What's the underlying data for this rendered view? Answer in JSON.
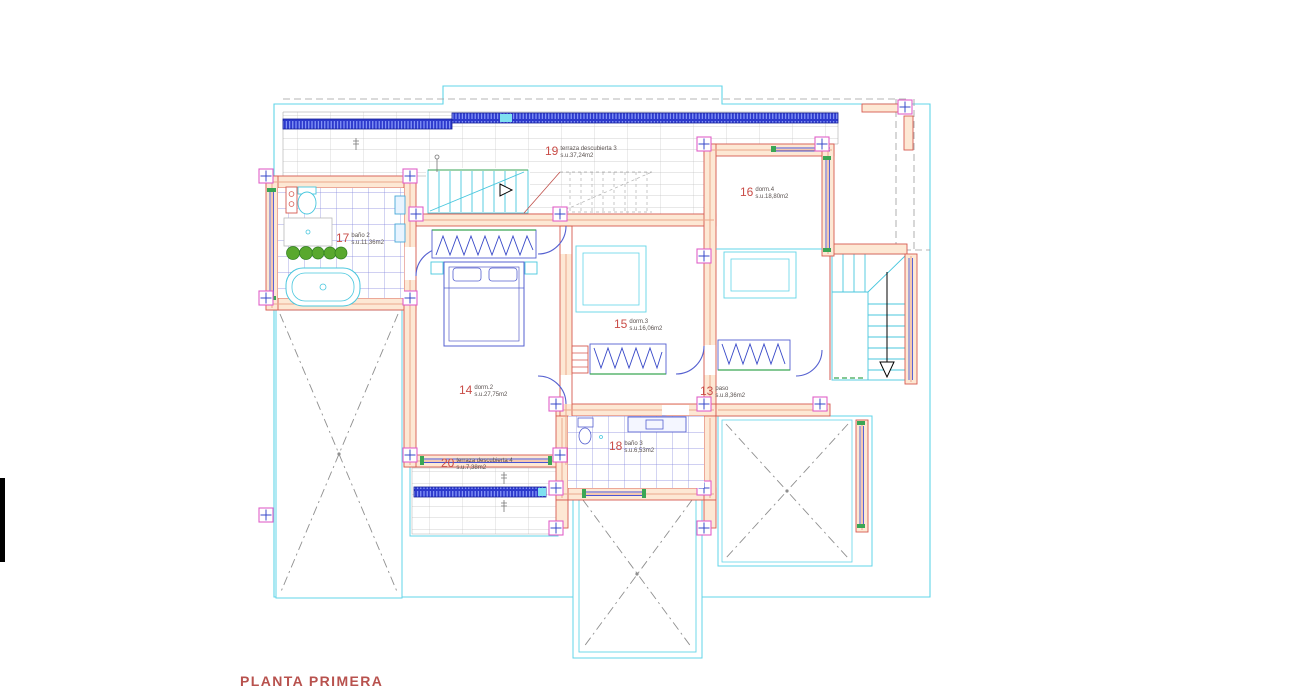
{
  "drawing": {
    "title": "PLANTA PRIMERA",
    "rooms": [
      {
        "id": "19",
        "name": "terraza descubierta 3",
        "area": "s.u.37,24m2"
      },
      {
        "id": "16",
        "name": "dorm.4",
        "area": "s.u.18,80m2"
      },
      {
        "id": "17",
        "name": "baño 2",
        "area": "s.u.11,36m2"
      },
      {
        "id": "15",
        "name": "dorm.3",
        "area": "s.u.16,06m2"
      },
      {
        "id": "14",
        "name": "dorm.2",
        "area": "s.u.27,75m2"
      },
      {
        "id": "13",
        "name": "paso",
        "area": "s.u.8,36m2"
      },
      {
        "id": "18",
        "name": "baño 3",
        "area": "s.u.6,53m2"
      },
      {
        "id": "20",
        "name": "terraza descubierta 4",
        "area": "s.u.7,38m2"
      }
    ],
    "colors": {
      "label_number": "#c94c47",
      "label_text": "#5a5250",
      "title": "#b8524e",
      "wall_fill": "#fde8d4",
      "wall_stroke": "#d65a50",
      "boundary_cyan": "#62d4e8",
      "hatch_blue": "#2c39cc",
      "detail_blue": "#3748c8",
      "green": "#3aa655",
      "column_pink": "#e060c8",
      "deck_gray": "#a0a0a0"
    }
  }
}
